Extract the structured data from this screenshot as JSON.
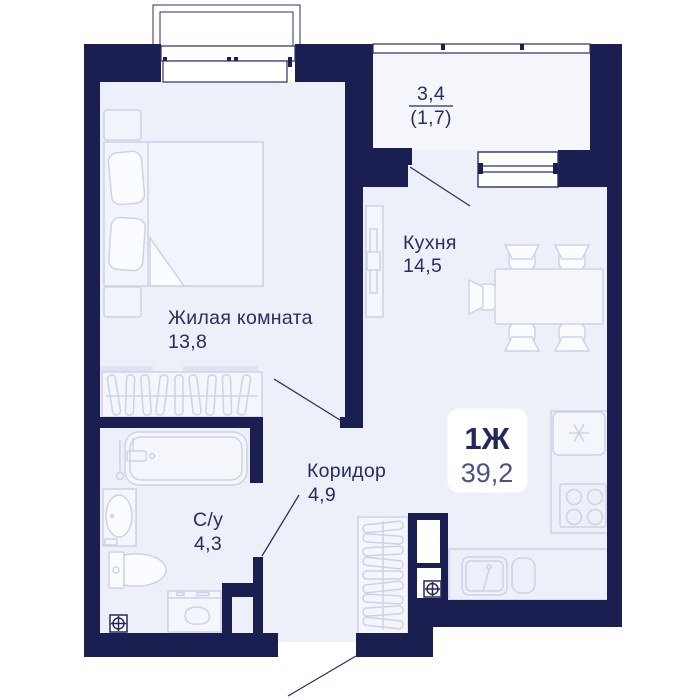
{
  "plan": {
    "unit_badge": {
      "type_label": "1Ж",
      "total_area": "39,2"
    },
    "rooms": {
      "living": {
        "name": "Жилая комната",
        "area": "13,8"
      },
      "kitchen": {
        "name": "Кухня",
        "area": "14,5"
      },
      "corridor": {
        "name": "Коридор",
        "area": "4,9"
      },
      "bathroom": {
        "name": "С/у",
        "area": "4,3"
      },
      "balcony": {
        "area_total": "3,4",
        "area_counted": "(1,7)"
      }
    },
    "icons": {
      "ventilation": "circle-cross",
      "freezer": "snowflake"
    },
    "colors": {
      "wall": "#1a1e50",
      "floor": "#edf0f8",
      "balcony_floor": "#f4f6fb",
      "furniture_stroke": "#ccd3e8",
      "label_text": "#272d60",
      "badge_type_text": "#23285c",
      "badge_area_text": "#4b5180",
      "background": "#ffffff"
    }
  }
}
